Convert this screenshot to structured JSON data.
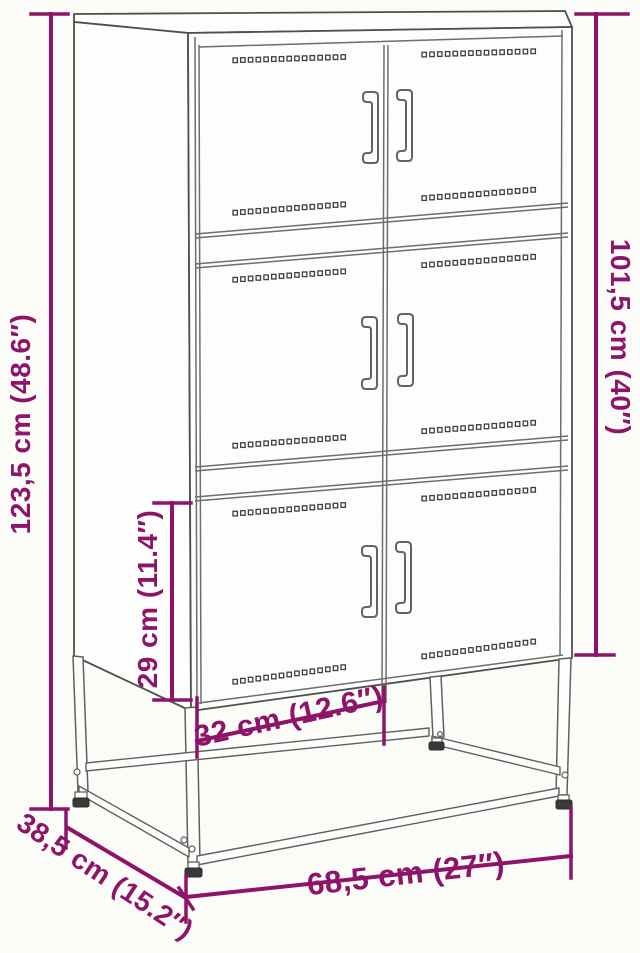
{
  "diagram": {
    "background": "#fbfbf8",
    "accent_color": "#8d1468",
    "line_color": "#5f5f5f",
    "labels": {
      "overall_height": "123,5 cm (48.6″)",
      "right_height": "101,5 cm (40″)",
      "compartment_height": "29 cm (11.4″)",
      "compartment_width": "32 cm (12.6″)",
      "overall_width": "68,5 cm (27″)",
      "depth": "38,5 cm (15.2″)"
    }
  }
}
